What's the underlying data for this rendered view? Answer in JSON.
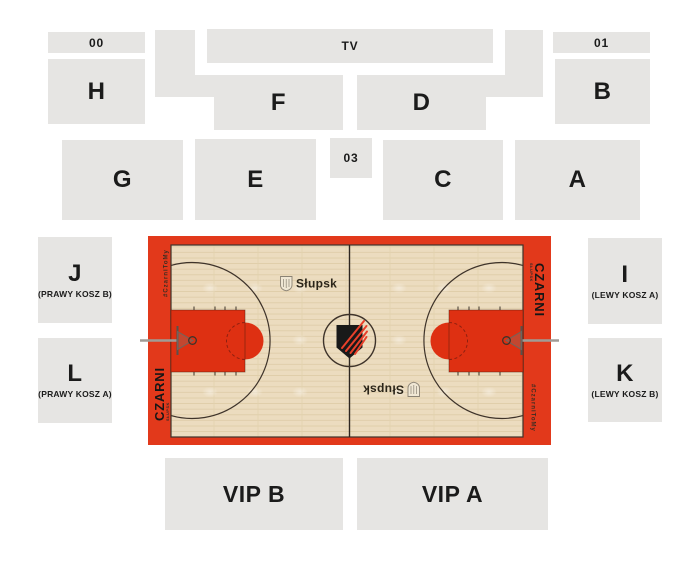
{
  "sections": {
    "s00": {
      "label": "00"
    },
    "tv": {
      "label": "TV"
    },
    "s01": {
      "label": "01"
    },
    "h": {
      "label": "H"
    },
    "f": {
      "label": "F"
    },
    "d": {
      "label": "D"
    },
    "b": {
      "label": "B"
    },
    "g": {
      "label": "G"
    },
    "e": {
      "label": "E"
    },
    "s03": {
      "label": "03"
    },
    "c": {
      "label": "C"
    },
    "a": {
      "label": "A"
    },
    "j": {
      "label": "J",
      "sublabel": "(PRAWY KOSZ B)"
    },
    "i": {
      "label": "I",
      "sublabel": "(LEWY KOSZ A)"
    },
    "l": {
      "label": "L",
      "sublabel": "(PRAWY KOSZ A)"
    },
    "k": {
      "label": "K",
      "sublabel": "(LEWY KOSZ B)"
    },
    "vip_b": {
      "label": "VIP B"
    },
    "vip_a": {
      "label": "VIP A"
    }
  },
  "court": {
    "team_name": "CZARNI",
    "team_sub": "SŁUPSK",
    "hashtag": "#CzarniToMy",
    "city": "Słupsk",
    "colors": {
      "red": "#e2391b",
      "key_red": "#de3012",
      "floor": "#ecdcbf",
      "line": "#3e332a",
      "section_bg": "#e6e5e3"
    }
  }
}
